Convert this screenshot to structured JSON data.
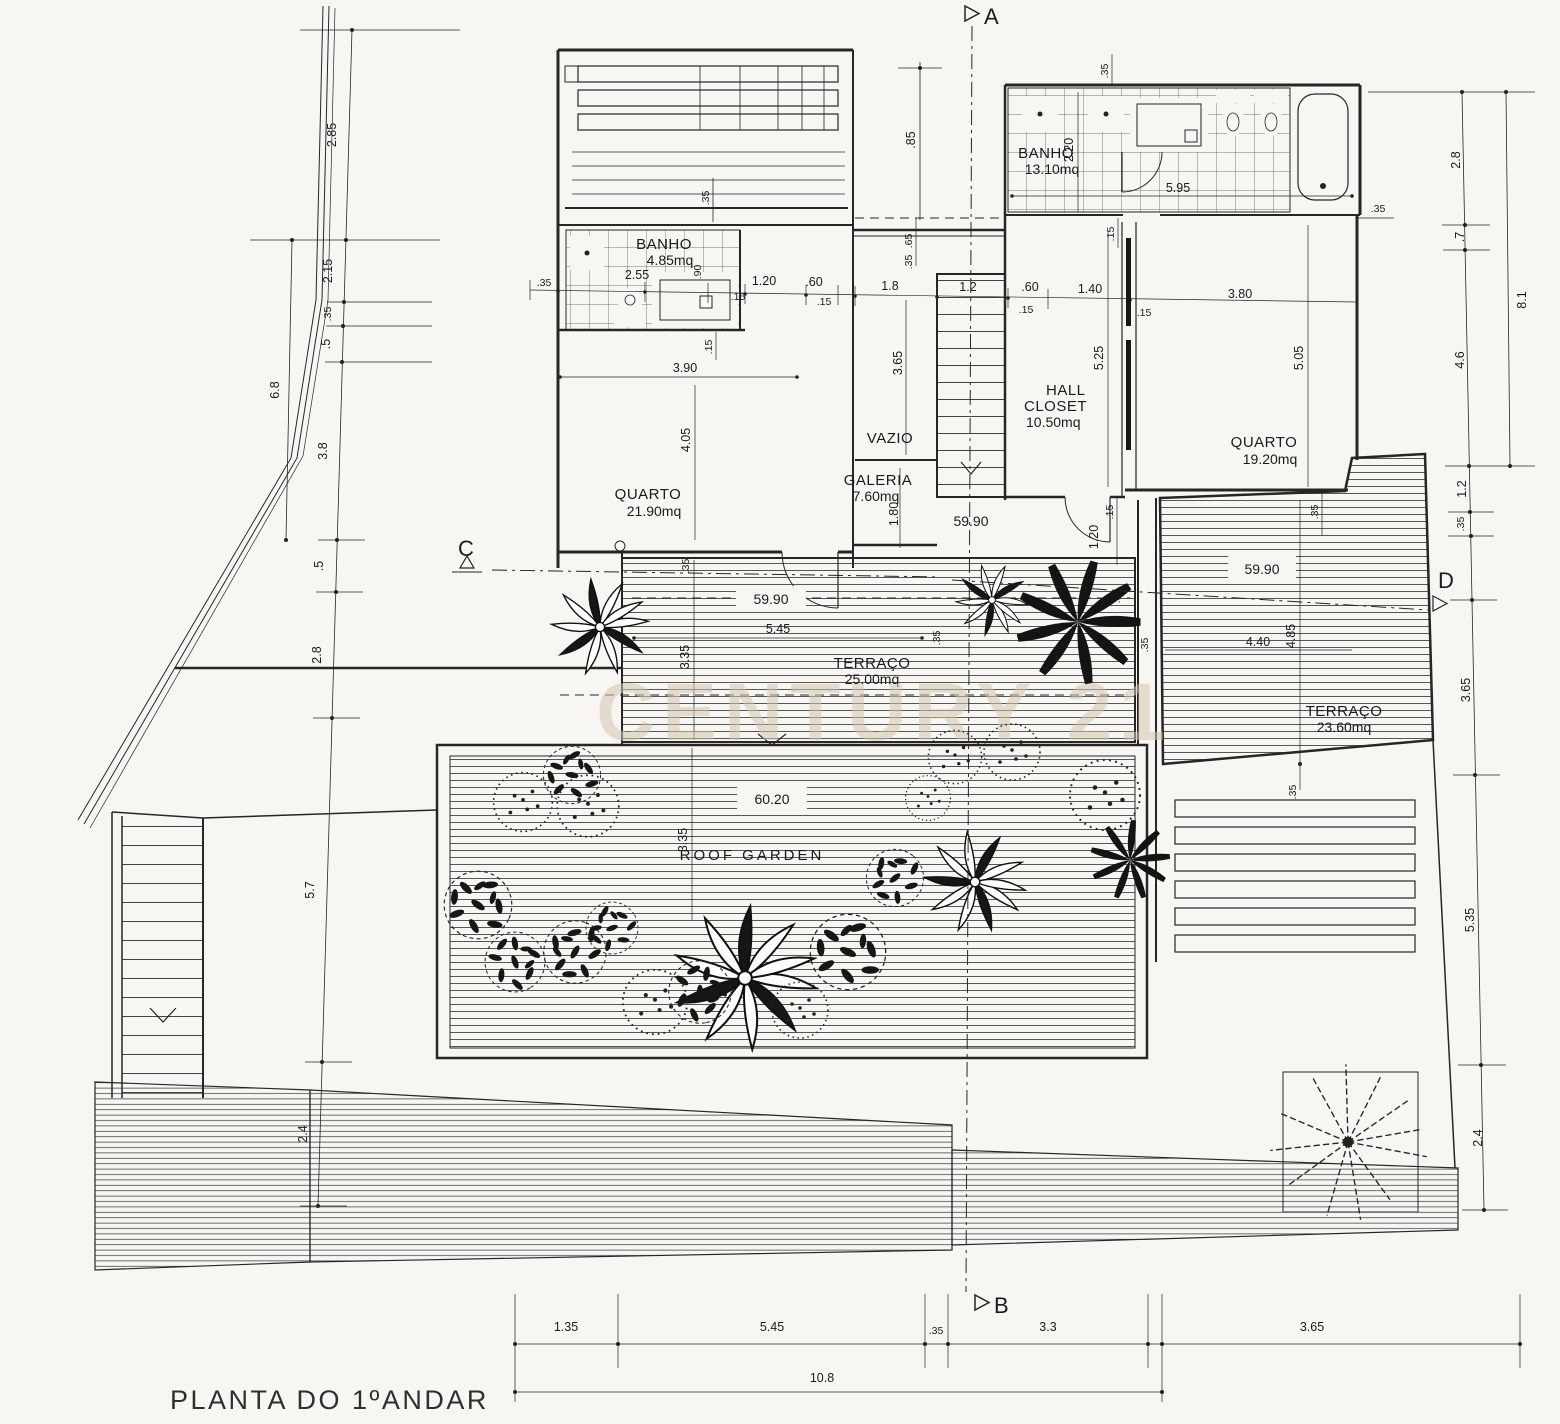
{
  "title": "PLANTA DO 1ºANDAR",
  "watermark": "CENTURY 21",
  "markers": {
    "a": "A",
    "b": "B",
    "c": "C",
    "d": "D"
  },
  "rooms": {
    "banho_small": {
      "name": "BANHO",
      "area": "4.85mq"
    },
    "banho_large": {
      "name": "BANHO",
      "area": "13.10mq"
    },
    "quarto_left": {
      "name": "QUARTO",
      "area": "21.90mq"
    },
    "quarto_right": {
      "name": "QUARTO",
      "area": "19.20mq"
    },
    "vazio": {
      "name": "VAZIO"
    },
    "galeria": {
      "name": "GALERIA",
      "area": "7.60mq"
    },
    "hall_closet": {
      "line1": "HALL",
      "line2": "CLOSET",
      "area": "10.50mq"
    },
    "terraco_mid": {
      "name": "TERRAÇO",
      "area": "25.00mq"
    },
    "terraco_right": {
      "name": "TERRAÇO",
      "area": "23.60mq"
    },
    "roof_garden": {
      "name": "ROOF  GARDEN"
    }
  },
  "levels": {
    "stair": "59.90",
    "terrace_mid": "59.90",
    "terrace_right": "59.90",
    "roof": "60.20"
  },
  "dims": {
    "left": [
      "2.85",
      "2.15",
      ".35",
      ".5",
      "6.8",
      "3.8",
      ".5",
      "2.8",
      "5.7",
      "2.4"
    ],
    "right": [
      "2.8",
      ".7",
      "8.1",
      "4.6",
      "1.2",
      ".35",
      "3.65",
      "5.35",
      "2.4"
    ],
    "bottom": [
      "1.35",
      "5.45",
      ".35",
      "3.3",
      "3.65",
      "10.8"
    ],
    "top": [
      ".35",
      ".85",
      ".35",
      "2.20",
      "5.95",
      ".35",
      ".15"
    ],
    "row": [
      ".35",
      "2.55",
      ".90",
      "1.20",
      ".15",
      ".60",
      ".15",
      "1.8",
      "1.2",
      ".60",
      ".15",
      "1.40",
      ".15",
      "3.80"
    ],
    "mid": [
      ".15",
      "3.90",
      "4.05",
      "3.65",
      ".65",
      ".35",
      "5.25",
      "5.05",
      "1.80",
      "1.20",
      ".15",
      ".35"
    ],
    "terrace": [
      "5.45",
      "3.35",
      ".35",
      ".35",
      ".35",
      "4.40",
      "4.85",
      ".35",
      "3.35",
      ".35"
    ]
  }
}
